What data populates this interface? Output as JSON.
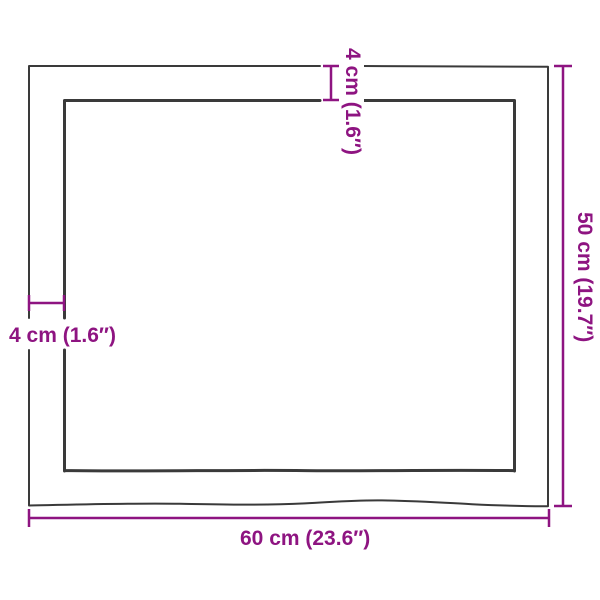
{
  "colors": {
    "accent": "#8e1481",
    "outline": "#3a3a3a"
  },
  "diagram": {
    "labels": {
      "top_thickness": "4 cm (1.6″)",
      "left_thickness": "4 cm (1.6″)",
      "height": "50 cm (19.7″)",
      "width": "60 cm (23.6″)"
    }
  }
}
